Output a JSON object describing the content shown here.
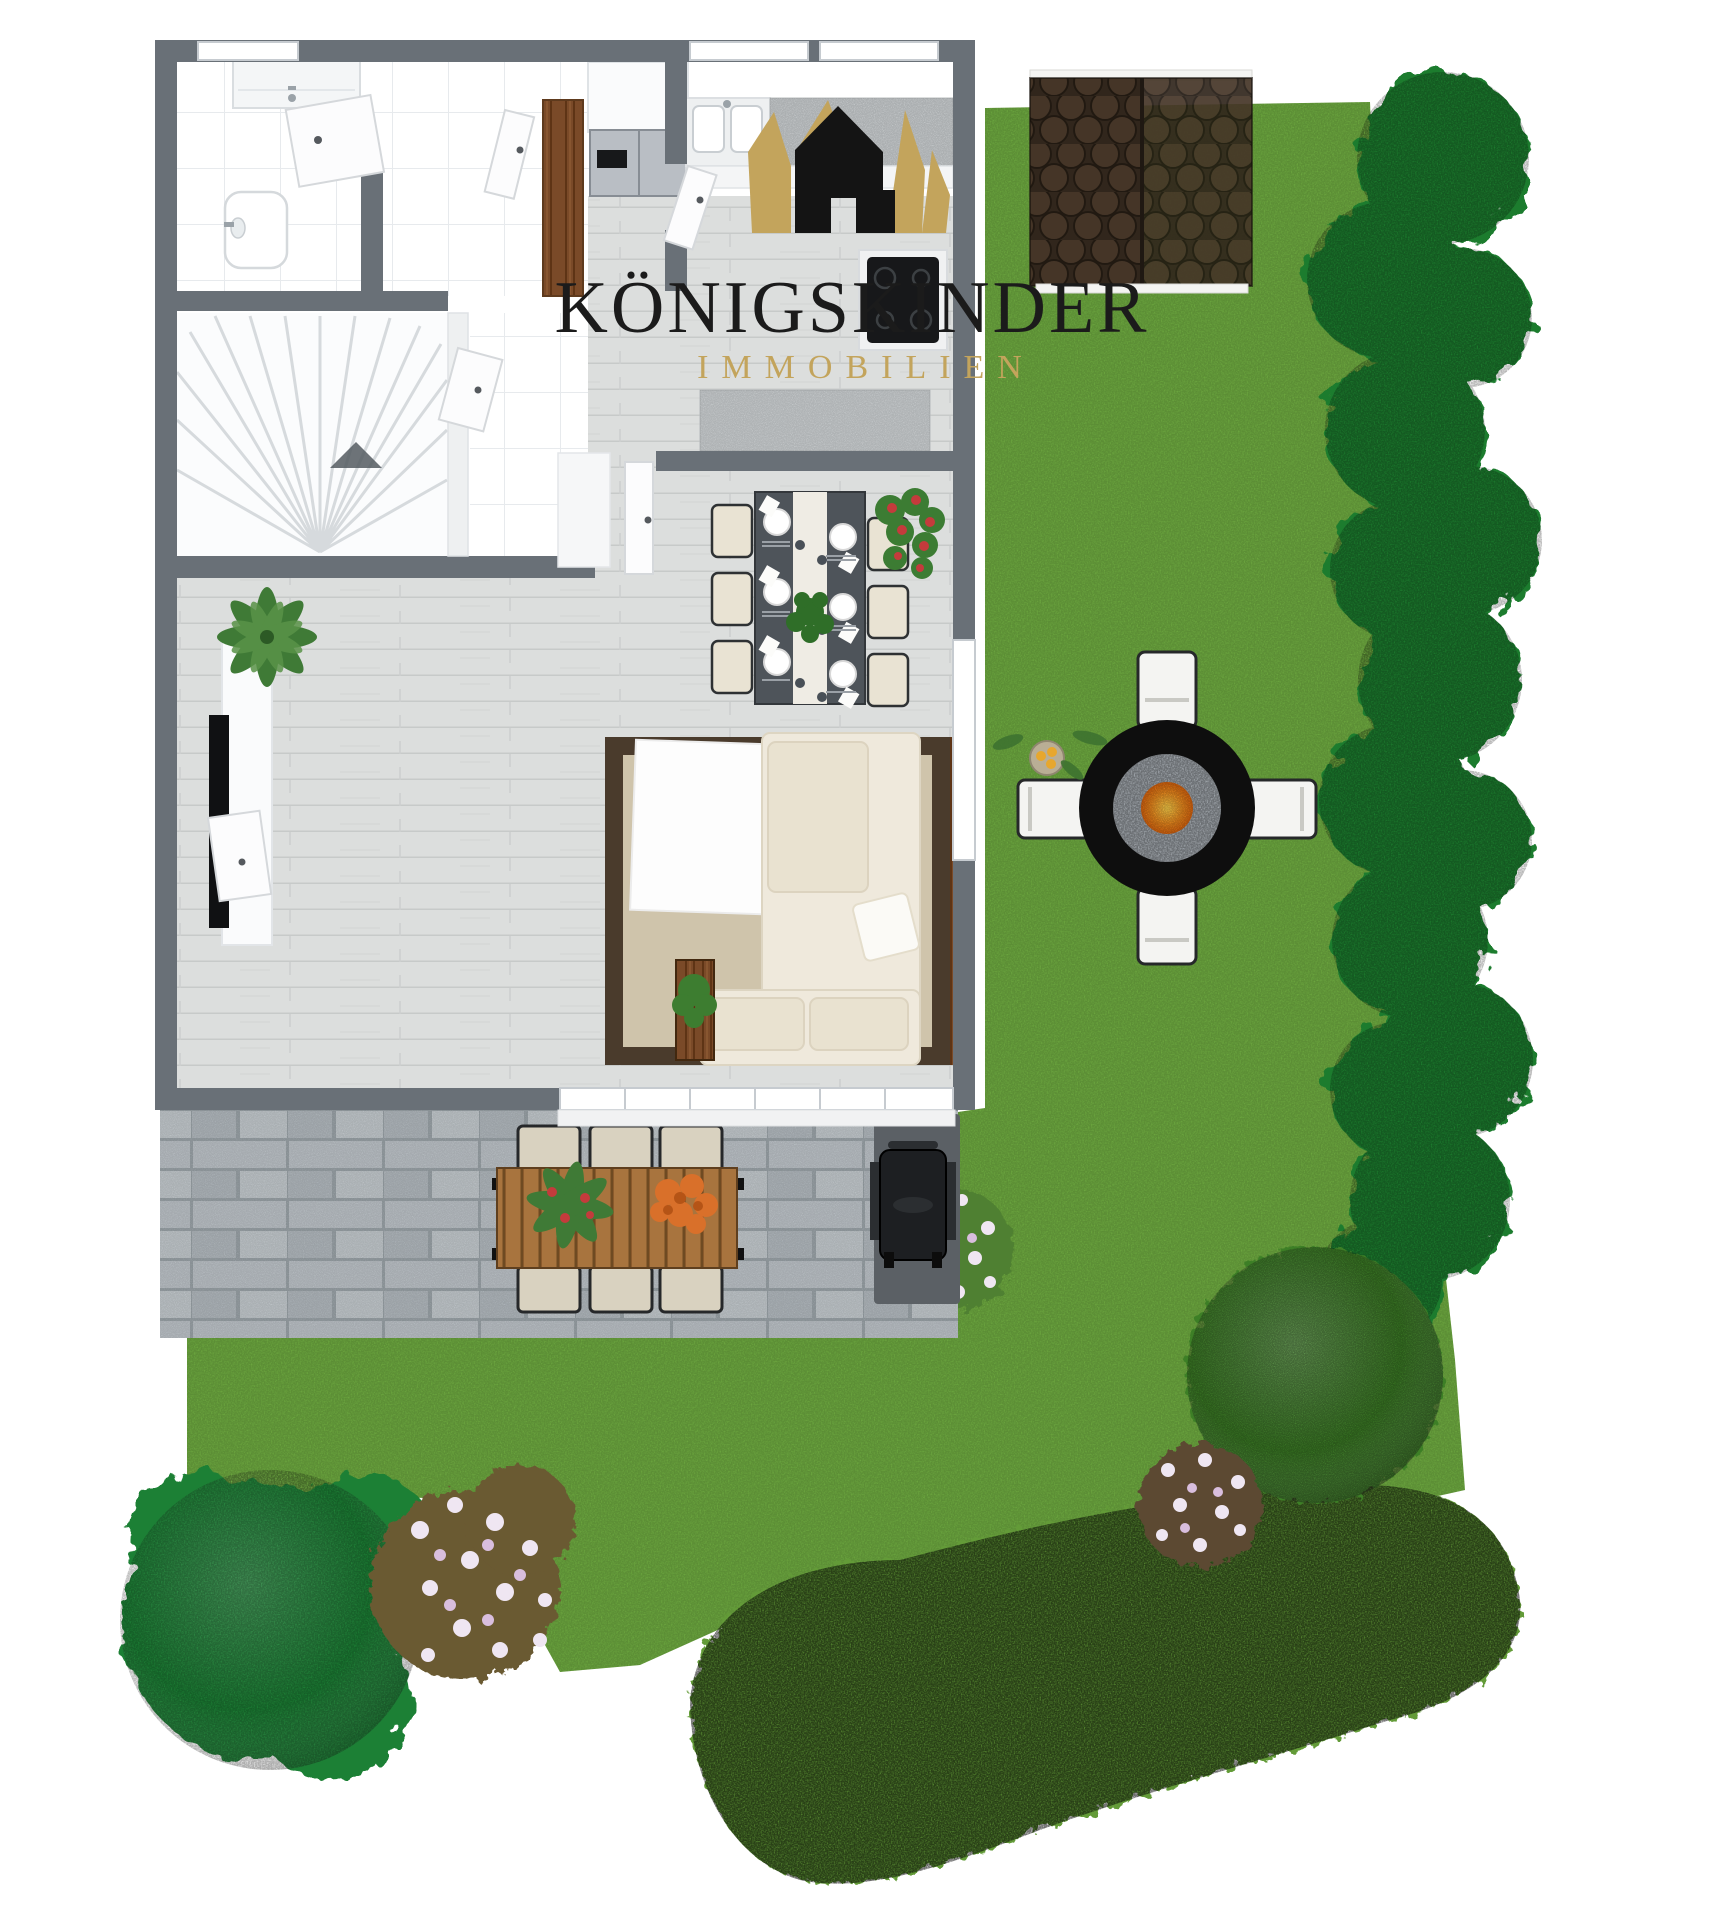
{
  "canvas": {
    "width": 1715,
    "height": 1920,
    "background": "#ffffff"
  },
  "logo": {
    "title": "KÖNIGSKINDER",
    "subtitle": "IMMOBILIEN",
    "icon": "crown-house-icon",
    "colors": {
      "title": "#1b1b1b",
      "subtitle": "#c3a45c",
      "gold": "#c3a45c",
      "black": "#141414"
    }
  },
  "palette": {
    "background": "#ffffff",
    "wall": "#697077",
    "wall_light": "#eef0f1",
    "grass": "#6ca73f",
    "hedge": "#1e7c2f",
    "topiary": "#3e7f27",
    "tree": "#1f8034",
    "groundcover": "#639b37",
    "groundcover_light": "#82b450",
    "flower_white": "#efe6f2",
    "flower_pink": "#d9bede",
    "shrub_leaves": "#6b5a33",
    "shed_roof": "#31261c",
    "shed_shingle": "#453527",
    "shed_trim": "#f4f4f2",
    "paver": "#b9bfc4",
    "paver_joint": "#99a1a6",
    "plank": "#dcdedd",
    "tile_line": "#e7eaed",
    "rug_border": "#4a3b2c",
    "rug_field": "#cfc4ab",
    "blanket": "#fdfdfd",
    "sofa": "#efe9dc",
    "sofa_cushion": "#e9e2d0",
    "chair_seat": "#e9e3d3",
    "chair_frame": "#2e3133",
    "dining_table": "#4e545a",
    "runner": "#efece4",
    "wood_warm": "#7a4a28",
    "outdoor_table": "#a8743e",
    "outdoor_sling": "#d9d2c0",
    "fire_pit": "#0e0e0e",
    "pebble": "#a6acb2",
    "fire": "#f08c1e",
    "grill": "#1d1f22",
    "grill_mat": "#5b6065",
    "fridge": "#b9bec4",
    "stove": "#17181a",
    "counter_speckle": "#c9cdcf",
    "white_furniture": "#fafbfc",
    "plant_green": "#3d7d30",
    "plant_red": "#c43b3c",
    "plant_orange": "#d9702a",
    "lemon": "#e7a72e",
    "side_table": "#b9ae95"
  }
}
